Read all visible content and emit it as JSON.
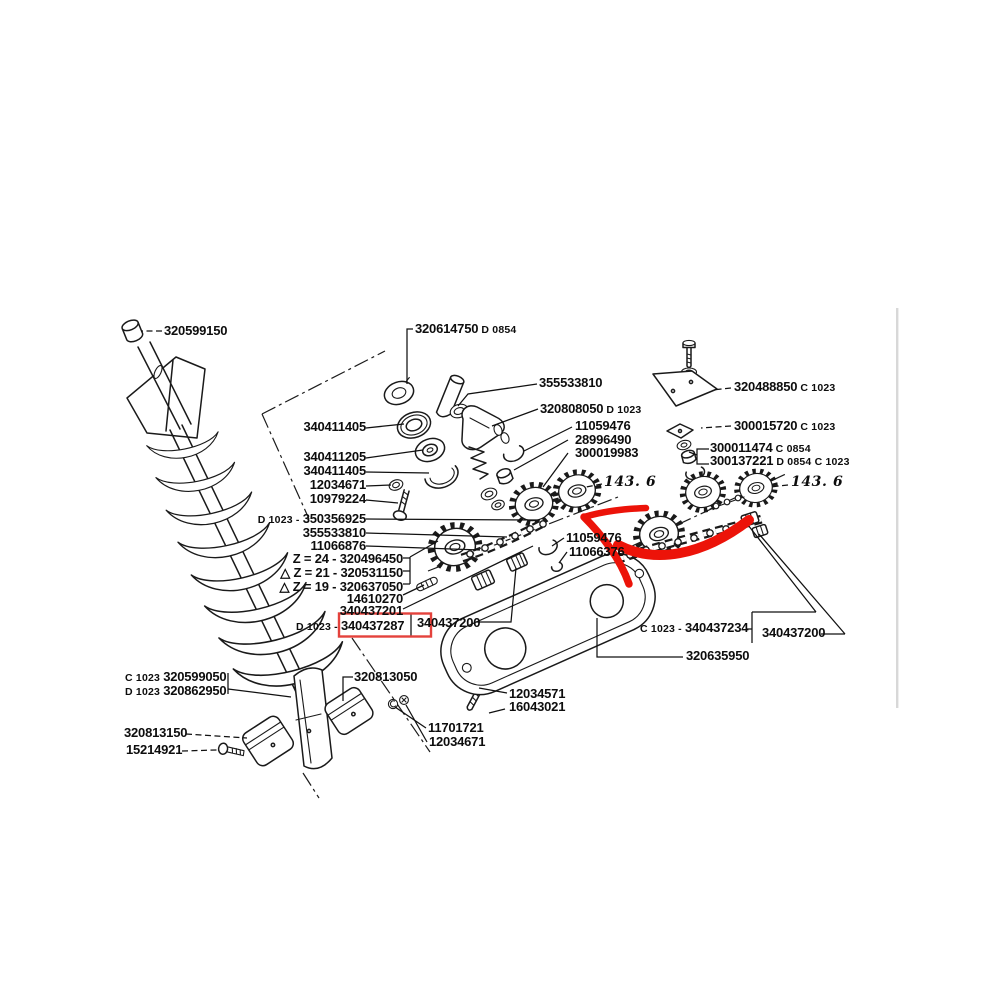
{
  "meta": {
    "document_type": "exploded parts diagram",
    "highlighted_part": "340437287"
  },
  "colors": {
    "background": "#ffffff",
    "ink": "#1a1a1a",
    "red_arrow": "#ec1309",
    "red_box": "#e4423c",
    "scan_artifact": "#d8d8d8"
  },
  "callouts": {
    "l01": {
      "num": "320599150"
    },
    "l02": {
      "num": "320614750",
      "suf": " D 0854"
    },
    "l03": {
      "num": "355533810"
    },
    "l04": {
      "num": "320808050",
      "suf": " D 1023"
    },
    "l05": {
      "num": "11059476"
    },
    "l06": {
      "num": "28996490"
    },
    "l07": {
      "num": "300019983"
    },
    "l08": {
      "num": "143. 6"
    },
    "l09": {
      "num": "320488850",
      "suf": " C 1023"
    },
    "l10": {
      "num": "300015720",
      "suf": " C 1023"
    },
    "l11": {
      "num": "300011474",
      "suf": " C 0854"
    },
    "l12": {
      "num": "300137221",
      "suf": " D 0854 C 1023"
    },
    "l13": {
      "num": "143. 6"
    },
    "l14": {
      "num": "340411405"
    },
    "l15": {
      "num": "340411205"
    },
    "l16": {
      "num": "340411405"
    },
    "l17": {
      "num": "12034671"
    },
    "l18": {
      "num": "10979224"
    },
    "l19": {
      "pre": "D 1023 - ",
      "num": "350356925"
    },
    "l20": {
      "num": "355533810"
    },
    "l21": {
      "num": "11066876"
    },
    "l22": {
      "num": "Z = 24 - 320496450"
    },
    "l23": {
      "num": "△ Z = 21 - 320531150"
    },
    "l24": {
      "num": "△ Z = 19 - 320637050"
    },
    "l25": {
      "num": "14610270"
    },
    "l26": {
      "num": "340437201"
    },
    "l27": {
      "pre": "D 1023 - ",
      "num": "340437287"
    },
    "l28": {
      "num": "340437200"
    },
    "l29": {
      "num": "11059476"
    },
    "l30": {
      "num": "11066376"
    },
    "l31": {
      "pre": "C 1023 - ",
      "num": "340437234"
    },
    "l32": {
      "num": "340437200"
    },
    "l33": {
      "num": "320635950"
    },
    "l34": {
      "pre": "C 1023 ",
      "num": "320599050"
    },
    "l35": {
      "pre": "D 1023 ",
      "num": "320862950"
    },
    "l36": {
      "num": "320813050"
    },
    "l37": {
      "num": "320813150"
    },
    "l38": {
      "num": "15214921"
    },
    "l39": {
      "num": "11701721"
    },
    "l40": {
      "num": "12034671"
    },
    "l41": {
      "num": "12034571"
    },
    "l42": {
      "num": "16043021"
    }
  }
}
